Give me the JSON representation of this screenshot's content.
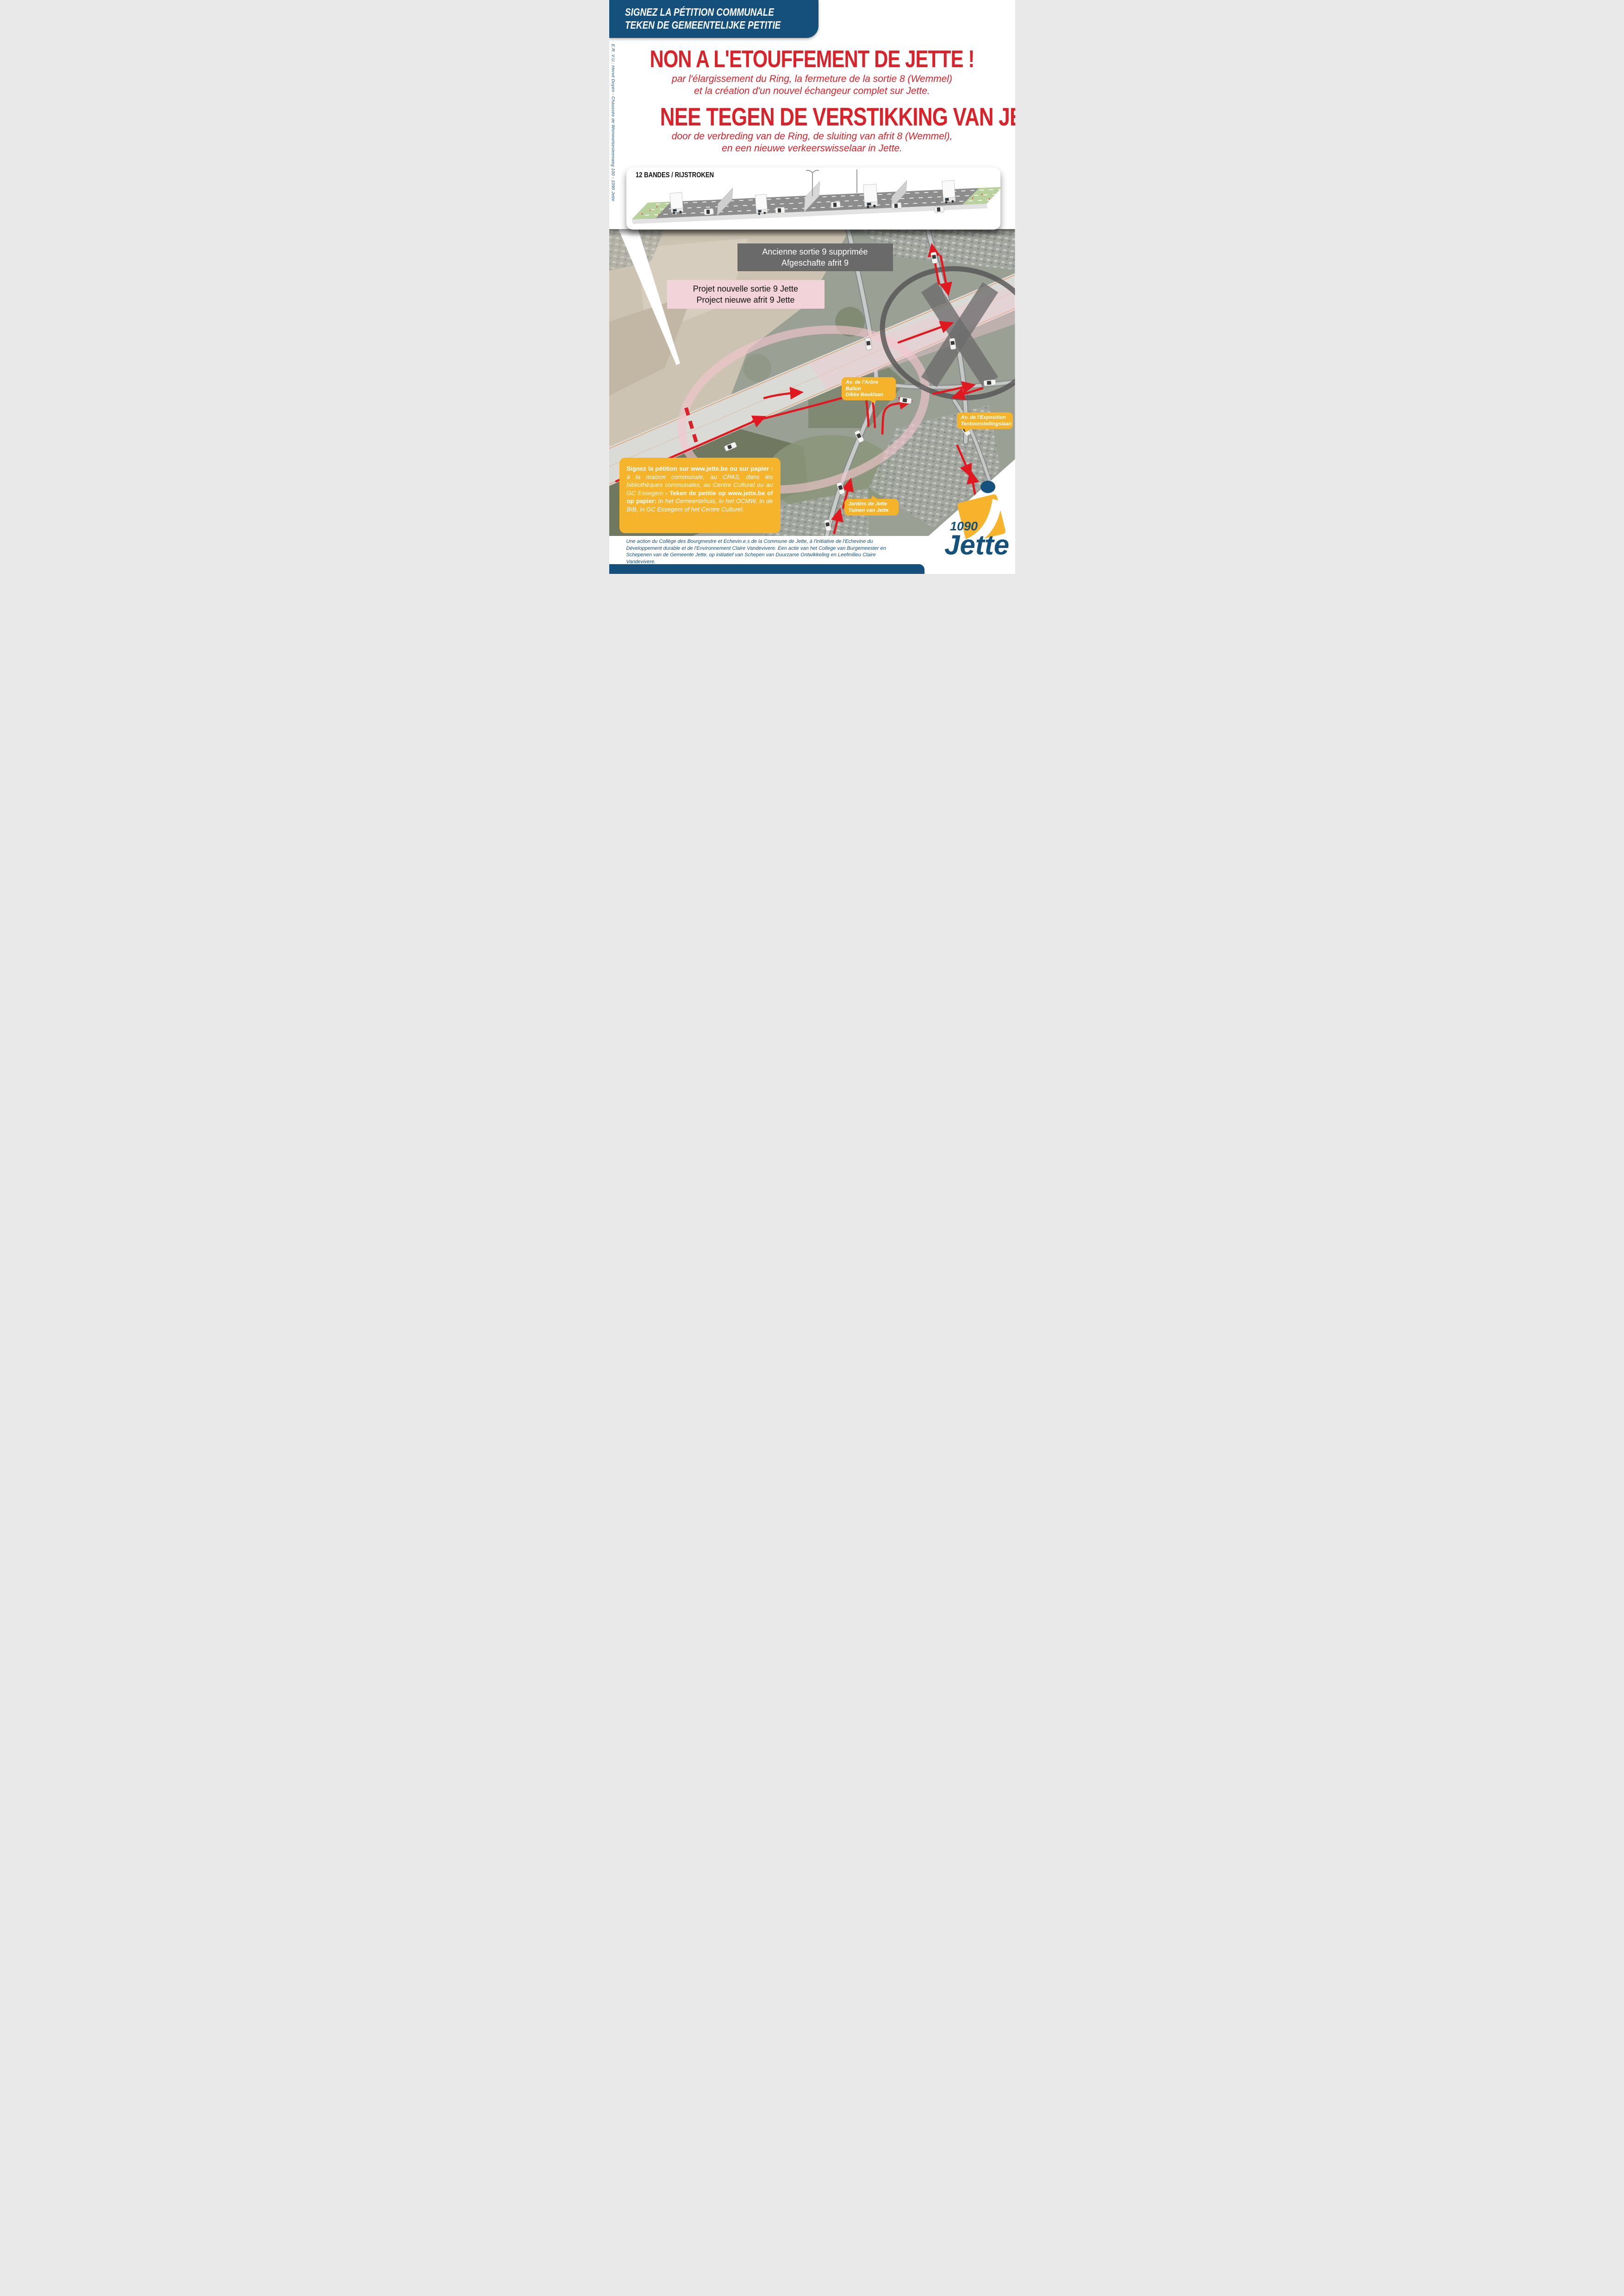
{
  "banner": {
    "line1": "SIGNEZ LA PÉTITION COMMUNALE",
    "line2": "TEKEN DE GEMEENTELIJKE PETITIE"
  },
  "sidebar": {
    "credit": "E.R. V.U.: Hervé Doyen - Chaussée de Wemmelsesteenweg 100 - 1090 Jette"
  },
  "headline_fr": {
    "title": "NON A L'ETOUFFEMENT DE JETTE !",
    "subtitle_line1": "par l'élargissement du Ring, la fermeture de la sortie 8 (Wemmel)",
    "subtitle_line2": "et la création d'un nouvel échangeur complet sur Jette."
  },
  "headline_nl": {
    "title": "NEE TEGEN DE VERSTIKKING VAN JETTE!",
    "subtitle_line1": "door de verbreding van de Ring, de sluiting van afrit 8 (Wemmel),",
    "subtitle_line2": "en een nieuwe verkeerswisselaar in Jette."
  },
  "diagram": {
    "title": "12 BANDES / RIJSTROKEN"
  },
  "map": {
    "label_old_exit": {
      "line1": "Ancienne sortie 9 supprimée",
      "line2": "Afgeschafte afrit 9"
    },
    "label_new_exit": {
      "line1": "Projet nouvelle sortie 9 Jette",
      "line2": "Project nieuwe afrit 9 Jette"
    },
    "bubble_arbre_ballon": {
      "line1": "Av. de l'Arbre Ballon",
      "line2": "Dikke Beuklaan"
    },
    "bubble_exposition": {
      "line1": "Av. de l'Exposition",
      "line2": "Tentoonstellingslaan"
    },
    "bubble_jardins": {
      "line1": "Jardins de Jette",
      "line2": "Tuinen van Jette"
    }
  },
  "petition_box": {
    "fr_bold": "Signez la pétition sur www.jette.be ou sur papier : ",
    "fr_italic": "à la maison communale, au CPAS, dans les bibliothèques communales, au Centre Culturel ou au GC Essegem ",
    "separator": "- ",
    "nl_bold": "Teken de petitie op www.jette.be of op papier: ",
    "nl_italic": "in het Gemeentehuis, in het OCMW, in de BIB, in GC Essegem of het Centre Culturel."
  },
  "footer": {
    "credit_fr": "Une action du Collège des Bourgmestre et Echevin.e.s de la Commune de Jette, à l'initiative de l'Echevine du Développement durable et de l'Environnement Claire Vandevivere. ",
    "credit_nl": "Een actie van het College van Burgemeester en Schepenen van de Gemeente Jette, op initiatief van Schepen van Duurzame Ontwikkeling en Leefmilieu Claire Vandevivere."
  },
  "logo": {
    "postcode": "1090",
    "name": "Jette"
  },
  "colors": {
    "brand_blue": "#15507d",
    "accent_red": "#d8232a",
    "accent_yellow": "#f6b42c",
    "pink_label": "#f1d3d9",
    "dark_label": "#6a6a6a"
  }
}
